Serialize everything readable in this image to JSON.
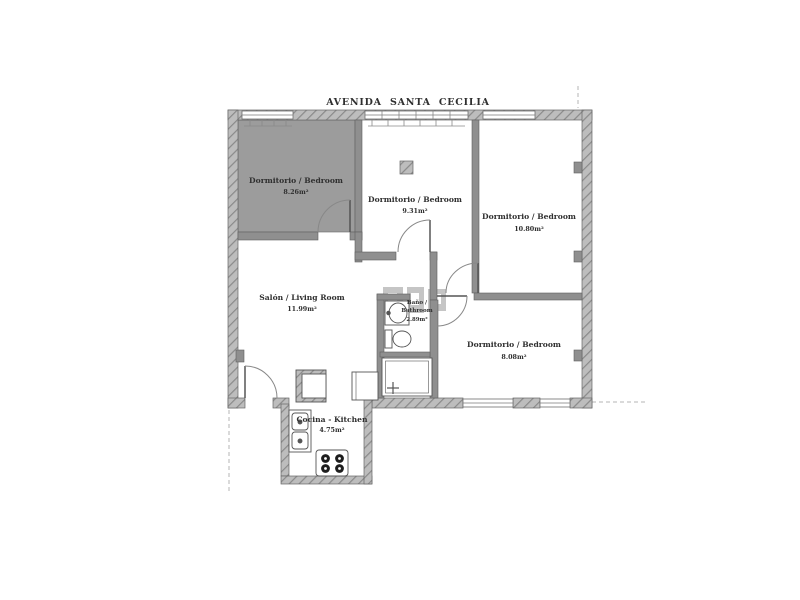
{
  "street": {
    "label": "AVENIDA SANTA CECILIA"
  },
  "rooms": [
    {
      "id": "bedroom-1",
      "name": "Dormitorio / Bedroom",
      "area": "8.26m²"
    },
    {
      "id": "bedroom-2",
      "name": "Dormitorio / Bedroom",
      "area": "9.31m²"
    },
    {
      "id": "bedroom-3",
      "name": "Dormitorio / Bedroom",
      "area": "10.80m²"
    },
    {
      "id": "living-room",
      "name": "Salón / Living Room",
      "area": "11.99m²"
    },
    {
      "id": "bathroom",
      "name": "Baño /",
      "name_en": "Bathroom",
      "area": "2.89m²"
    },
    {
      "id": "bedroom-4",
      "name": "Dormitorio / Bedroom",
      "area": "8.08m²"
    },
    {
      "id": "kitchen",
      "name": "Cocina - Kitchen",
      "area": "4.75m²"
    }
  ],
  "colors": {
    "interior_wall": "#8f8f8f",
    "hatch_background": "#bdbdbd",
    "hatch_line": "#8a8a8a",
    "highlight_room_fill": "#9c9c9c",
    "outline": "#555555",
    "text": "#2f2f2f",
    "watermark": "#bcbcbc"
  }
}
